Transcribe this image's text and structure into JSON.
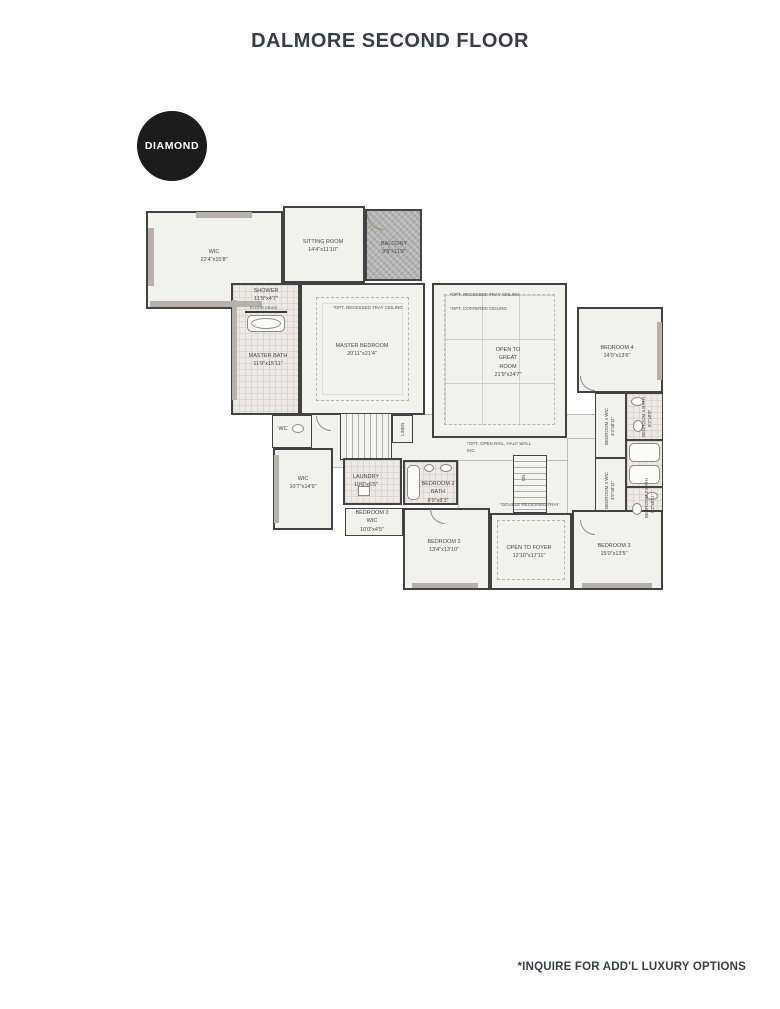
{
  "page": {
    "title": "DALMORE SECOND FLOOR",
    "footer_note": "*INQUIRE FOR ADD'L LUXURY OPTIONS"
  },
  "badge": {
    "label": "DIAMOND"
  },
  "rooms": {
    "master_wic": {
      "name": "WIC",
      "dims": "22'4\"x15'8\""
    },
    "sitting": {
      "name": "SITTING ROOM",
      "dims": "14'4\"x11'10\""
    },
    "balcony": {
      "name": "BALCONY",
      "dims": "9'8\"x11'9\""
    },
    "shower": {
      "name": "SHOWER",
      "dims": "11'9\"x4'7\""
    },
    "master_bath": {
      "name": "MASTER BATH",
      "dims": "11'9\"x15'11\""
    },
    "master_bedroom": {
      "name": "MASTER BEDROOM",
      "dims": "20'11\"x21'4\"",
      "note": "*OPT. RECESSED TRAY CEILING"
    },
    "great_room": {
      "l1": "OPEN TO",
      "l2": "GREAT",
      "l3": "ROOM",
      "dims": "21'9\"x24'7\"",
      "note1": "*OPT. RECESSED TRAY CEILING",
      "note2": "*OPT. COFFERED CEILING"
    },
    "bedroom4": {
      "name": "BEDROOM 4",
      "dims": "14'0\"x13'6\""
    },
    "bedroom4_wic": {
      "name": "BEDROOM 4 WIC",
      "dims": "4'4\"x8'11\""
    },
    "bedroom4_bath": {
      "name": "BEDROOM 4 BATH",
      "dims": "5'2\"x8'8\""
    },
    "bedroom3_wic": {
      "name": "BEDROOM 3 WIC",
      "dims": "4'5\"x8'11\""
    },
    "bedroom3_bath": {
      "name": "BEDROOM 3 BATH",
      "dims": "5'2\"x8'11\""
    },
    "wic2": {
      "name": "WIC",
      "dims": "10'7\"x14'9\""
    },
    "laundry": {
      "name": "LAUNDRY",
      "dims": "10'6\"x6'5\""
    },
    "bedroom2_bath": {
      "l1": "BEDROOM 2",
      "l2": "BATH",
      "dims": "8'9\"x8'3\""
    },
    "bedroom2_wic": {
      "l1": "BEDROOM 2",
      "l2": "WIC",
      "dims": "10'0\"x4'5\""
    },
    "bedroom2": {
      "name": "BEDROOM 2",
      "dims": "13'4\"x13'10\""
    },
    "foyer": {
      "name": "OPEN TO FOYER",
      "dims": "12'10\"x17'11\"",
      "note": "*DOUBLE RECESSED TRAY"
    },
    "bedroom3": {
      "name": "BEDROOM 3",
      "dims": "15'0\"x13'5\""
    }
  },
  "labels": {
    "wc": "WC",
    "linen": "LINEN",
    "dn": "DN",
    "floor_drain": "FLOOR DRAIN",
    "half_wall_note": "*OPT. OPEN RAIL, HALF WALL INC."
  },
  "colors": {
    "wall": "#424242",
    "accent_wall": "#b8b0aa",
    "room_fill": "#f1f1ef",
    "balcony_fill": "#b2b2b2",
    "badge_bg": "#1c1c1c",
    "text": "#48484c"
  }
}
